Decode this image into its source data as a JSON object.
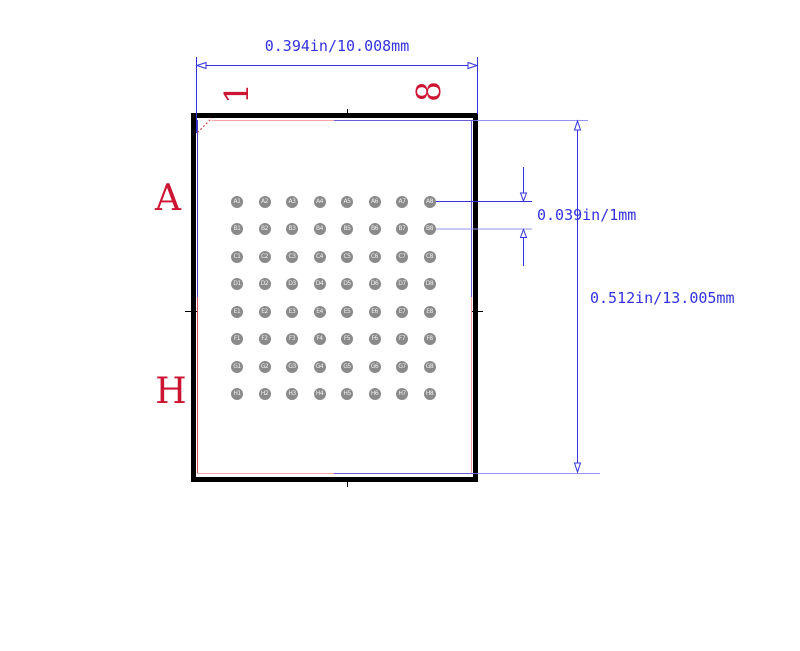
{
  "diagram": {
    "dimensions": {
      "width_label": "0.394in/10.008mm",
      "pitch_label": "0.039in/1mm",
      "height_label": "0.512in/13.005mm"
    },
    "row_labels": {
      "first": "A",
      "last": "H"
    },
    "column_labels": {
      "first": "1",
      "last": "8"
    },
    "grid": {
      "rows": 8,
      "cols": 8
    },
    "pad_labels": [
      "A1",
      "A2",
      "A3",
      "A4",
      "A5",
      "A6",
      "A7",
      "A8",
      "B1",
      "B2",
      "B3",
      "B4",
      "B5",
      "B6",
      "B7",
      "B8",
      "C1",
      "C2",
      "C3",
      "C4",
      "C5",
      "C6",
      "C7",
      "C8",
      "D1",
      "D2",
      "D3",
      "D4",
      "D5",
      "D6",
      "D7",
      "D8",
      "E1",
      "E2",
      "E3",
      "E4",
      "E5",
      "E6",
      "E7",
      "E8",
      "F1",
      "F2",
      "F3",
      "F4",
      "F5",
      "F6",
      "F7",
      "F8",
      "G1",
      "G2",
      "G3",
      "G4",
      "G5",
      "G6",
      "G7",
      "G8",
      "H1",
      "H2",
      "H3",
      "H4",
      "H5",
      "H6",
      "H7",
      "H8"
    ],
    "colors": {
      "dimension_blue": "#3232e0",
      "light_blue": "#9494f0",
      "inner_blue": "#6a5cd8",
      "left_blue": "#4438c8",
      "inner_pink": "#f2a4a4",
      "inner_red": "#d85060",
      "label_red": "#cc1433",
      "pad_gray": "#8a8a8a",
      "pad_text": "#f2f2f2",
      "outline_black": "#000000"
    }
  }
}
